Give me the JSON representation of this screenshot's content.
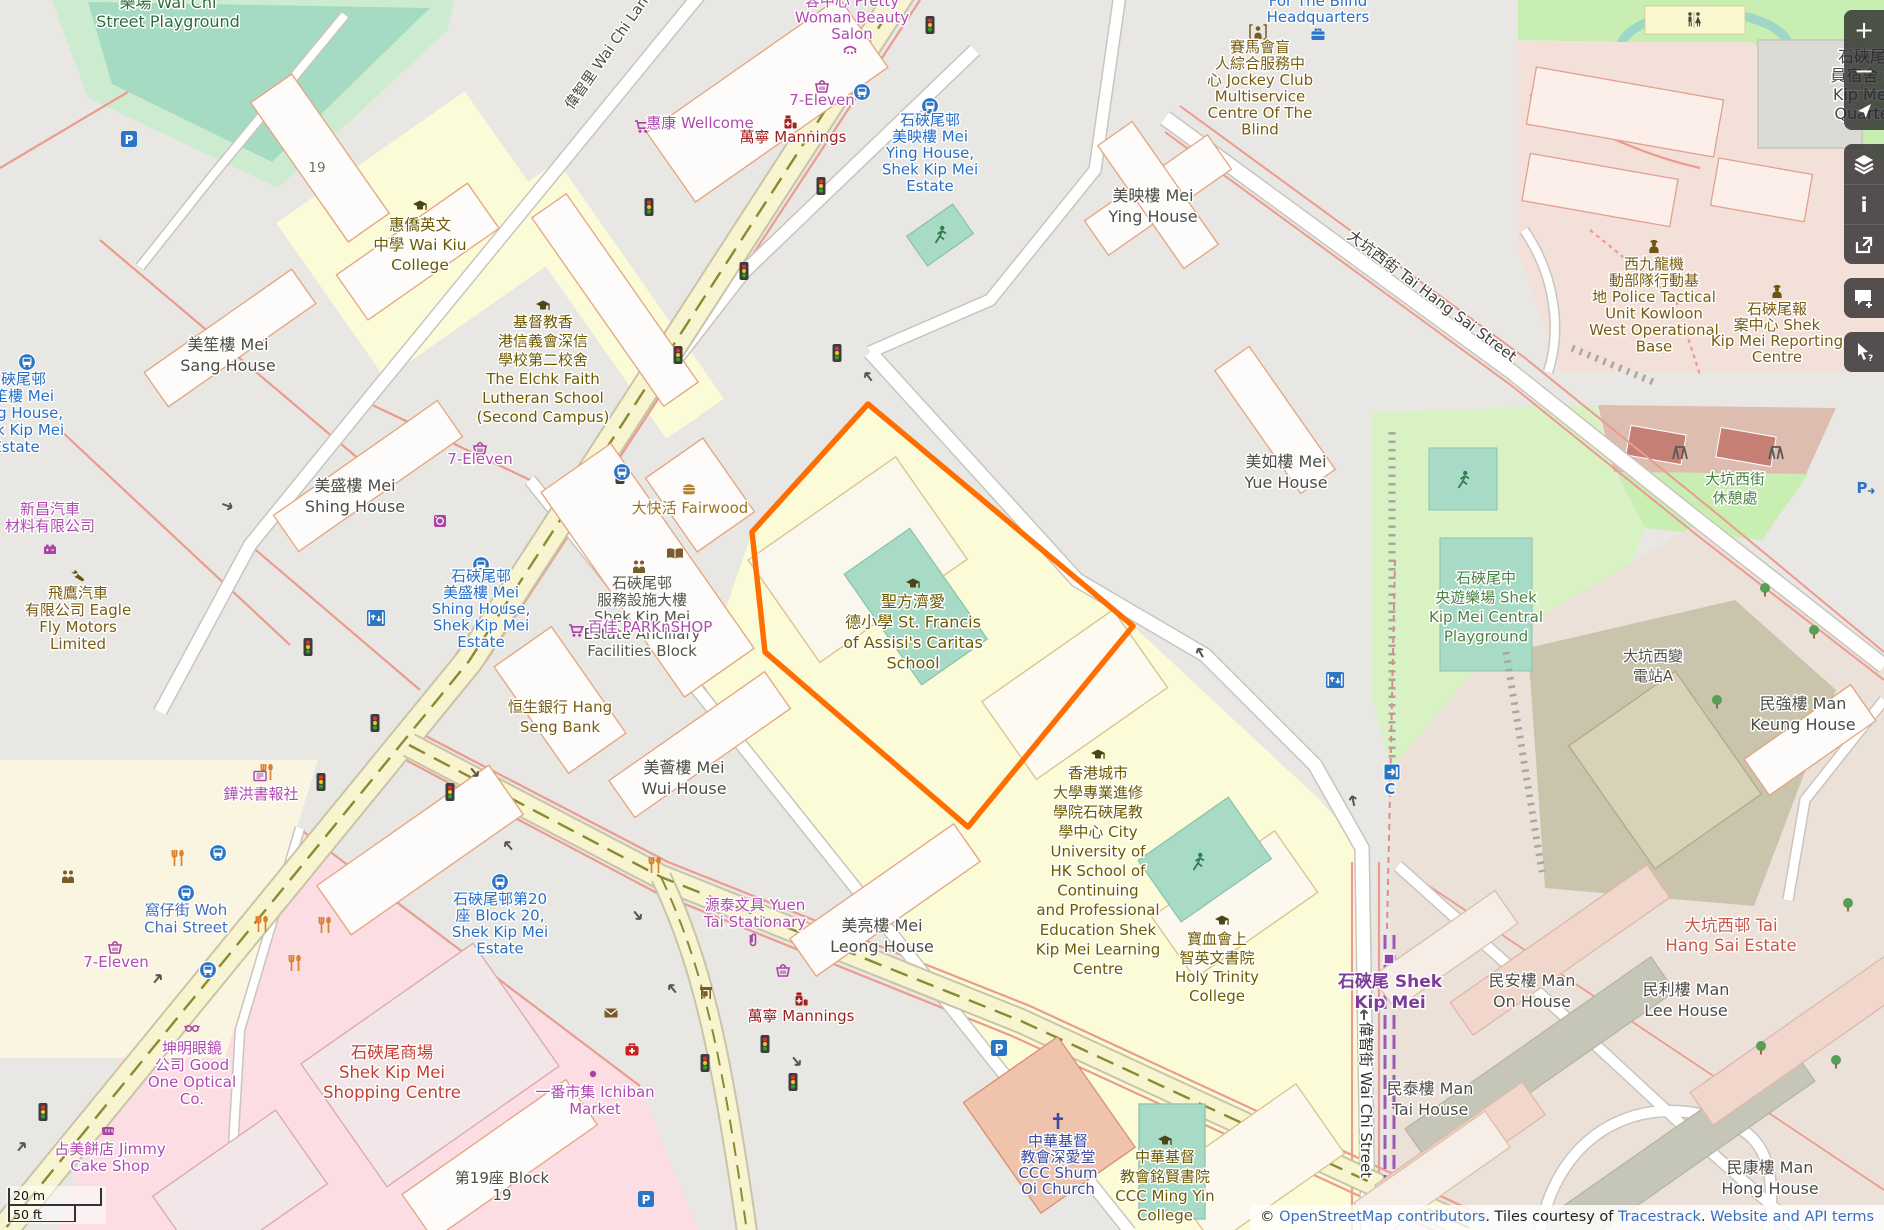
{
  "map": {
    "palette": {
      "selection_orange": "#ff6e00",
      "link_blue": "#3a6fc4",
      "station_purple": "#7d3c98",
      "road_yellow": "#f8f4cf",
      "park_green": "#c8eeb2",
      "pitch_teal": "#a8dbc6"
    },
    "scale_bar": {
      "metric": "20 m",
      "imperial": "50 ft"
    },
    "attribution": {
      "prefix": "© ",
      "osm_link": "OpenStreetMap contributors",
      "sep1": ". Tiles courtesy of ",
      "tiles_link": "Tracestrack",
      "sep2": ". ",
      "terms_link": "Website and API terms"
    },
    "sidebar": {
      "zoom_in": "+",
      "zoom_out": "−",
      "info": "i",
      "buttons": [
        "zoom-in",
        "zoom-out",
        "locate",
        "layers",
        "info",
        "share",
        "add-note",
        "query-features"
      ]
    },
    "selected_feature": {
      "outline_color": "#ff6e00"
    },
    "labels": [
      {
        "t": [
          "樂場 Wai Chi",
          "Street Playground"
        ],
        "x": 168,
        "y": 8,
        "c": "#2f6e3a",
        "s": 16,
        "lh": 19
      },
      {
        "t": [
          "19"
        ],
        "x": 317,
        "y": 172,
        "c": "#6e6e64",
        "s": 13.5
      },
      {
        "t": [
          "惠僑英文",
          "中學 Wai Kiu",
          "College"
        ],
        "x": 420,
        "y": 230,
        "c": "#6d5a00",
        "s": 15.5,
        "lh": 20
      },
      {
        "t": [
          "基督教香",
          "港信義會深信",
          "學校第二校舍",
          "The Elchk Faith",
          "Lutheran School",
          "(Second Campus)"
        ],
        "x": 543,
        "y": 327,
        "c": "#6d5a00",
        "lh": 19
      },
      {
        "t": [
          "美笙樓 Mei",
          "Sang House"
        ],
        "x": 228,
        "y": 350,
        "c": "#4d4c46",
        "s": 16,
        "lh": 21
      },
      {
        "t": [
          "石硤尾邨",
          "美笙樓 Mei",
          "Sang House,",
          "Shek Kip Mei",
          "Estate"
        ],
        "x": 16,
        "y": 384,
        "c": "#2a6fc7",
        "lh": 17
      },
      {
        "t": [
          "新昌汽車",
          "材料有限公司"
        ],
        "x": 50,
        "y": 514,
        "c": "#b14ab0",
        "lh": 17
      },
      {
        "t": [
          "飛鷹汽車",
          "有限公司 Eagle",
          "Fly Motors",
          "Limited"
        ],
        "x": 78,
        "y": 598,
        "c": "#7a5c12",
        "lh": 17
      },
      {
        "t": [
          "美盛樓 Mei",
          "Shing House"
        ],
        "x": 355,
        "y": 491,
        "c": "#4d4c46",
        "s": 16,
        "lh": 21
      },
      {
        "t": [
          "7-Eleven"
        ],
        "x": 480,
        "y": 464,
        "c": "#b14ab0"
      },
      {
        "t": [
          "大快活 Fairwood"
        ],
        "x": 690,
        "y": 513,
        "c": "#9b7618"
      },
      {
        "t": [
          "石硤尾邨",
          "服務設施大樓",
          "Shek Kip Mei",
          "Estate Ancillary",
          "Facilities Block"
        ],
        "x": 642,
        "y": 588,
        "c": "#55544c",
        "lh": 17
      },
      {
        "t": [
          "百佳 PARKnSHOP"
        ],
        "x": 650,
        "y": 632,
        "c": "#b14ab0"
      },
      {
        "t": [
          "恒生銀行 Hang",
          "Seng Bank"
        ],
        "x": 560,
        "y": 712,
        "c": "#7a5c12",
        "lh": 20
      },
      {
        "t": [
          "聖方濟愛",
          "德小學 St. Francis",
          "of Assisi's Caritas",
          "School"
        ],
        "x": 913,
        "y": 607,
        "c": "#6d5a00",
        "s": 16,
        "lh": 20.5
      },
      {
        "t": [
          "美薈樓 Mei",
          "Wui House"
        ],
        "x": 684,
        "y": 773,
        "c": "#4d4c46",
        "s": 16,
        "lh": 21
      },
      {
        "t": [
          "美亮樓 Mei",
          "Leong House"
        ],
        "x": 882,
        "y": 931,
        "c": "#4d4c46",
        "s": 16,
        "lh": 21
      },
      {
        "t": [
          "源泰文具 Yuen",
          "Tai Stationary"
        ],
        "x": 755,
        "y": 910,
        "c": "#b14ab0",
        "lh": 17
      },
      {
        "t": [
          "石硤尾邨第20",
          "座 Block 20,",
          "Shek Kip Mei",
          "Estate"
        ],
        "x": 500,
        "y": 904,
        "c": "#2a6fc7",
        "lh": 16.5
      },
      {
        "t": [
          "萬寧 Mannings"
        ],
        "x": 801,
        "y": 1021,
        "c": "#a01f1f"
      },
      {
        "t": [
          "一番市集 Ichiban",
          "Market"
        ],
        "x": 595,
        "y": 1097,
        "c": "#b14ab0",
        "lh": 17
      },
      {
        "t": [
          "石硤尾商場",
          "Shek Kip Mei",
          "Shopping Centre"
        ],
        "x": 392,
        "y": 1058,
        "c": "#c23f33",
        "s": 16.5,
        "lh": 20
      },
      {
        "t": [
          "坤明眼鏡",
          "公司 Good",
          "One Optical",
          "Co."
        ],
        "x": 192,
        "y": 1053,
        "c": "#b14ab0",
        "lh": 17
      },
      {
        "t": [
          "占美餅店 Jimmy",
          "Cake Shop"
        ],
        "x": 110,
        "y": 1154,
        "c": "#b14ab0",
        "lh": 17
      },
      {
        "t": [
          "窩仔街 Woh",
          "Chai Street"
        ],
        "x": 186,
        "y": 915,
        "c": "#3f6fbe",
        "lh": 17.5
      },
      {
        "t": [
          "7-Eleven"
        ],
        "x": 116,
        "y": 967,
        "c": "#b14ab0"
      },
      {
        "t": [
          "鏵洪書報社"
        ],
        "x": 261,
        "y": 799,
        "c": "#b14ab0"
      },
      {
        "t": [
          "第19座 Block",
          "19"
        ],
        "x": 502,
        "y": 1183,
        "c": "#4d4c46",
        "lh": 17
      },
      {
        "t": [
          "美如樓 Mei",
          "Yue House"
        ],
        "x": 1286,
        "y": 467,
        "c": "#4d4c46",
        "s": 16,
        "lh": 21
      },
      {
        "t": [
          "美映樓 Mei",
          "Ying House"
        ],
        "x": 1153,
        "y": 201,
        "c": "#4d4c46",
        "s": 16,
        "lh": 21
      },
      {
        "t": [
          "石硤尾邨",
          "美映樓 Mei",
          "Ying House,",
          "Shek Kip Mei",
          "Estate"
        ],
        "x": 930,
        "y": 125,
        "c": "#2a6fc7",
        "lh": 16.5
      },
      {
        "t": [
          "容中心 Pretty",
          "Woman Beauty",
          "Salon"
        ],
        "x": 852,
        "y": 6,
        "c": "#b14ab0",
        "lh": 16.5
      },
      {
        "t": [
          "7-Eleven"
        ],
        "x": 822,
        "y": 105,
        "c": "#b14ab0"
      },
      {
        "t": [
          "惠康 Wellcome"
        ],
        "x": 700,
        "y": 128,
        "c": "#b14ab0"
      },
      {
        "t": [
          "萬寧 Mannings"
        ],
        "x": 793,
        "y": 142,
        "c": "#a01f1f"
      },
      {
        "t": [
          "偉智里 Wai Chi Lane"
        ],
        "x": 613,
        "y": 52,
        "c": "#4a4a40",
        "s": 14.5,
        "r": -55
      },
      {
        "t": [
          "大坑西街 Tai Hang Sai Street"
        ],
        "x": 1429,
        "y": 300,
        "c": "#403f39,",
        "s": 15,
        "r": 37
      },
      {
        "t": [
          "偉智街 Wai Chi Street"
        ],
        "x": 1361,
        "y": 1100,
        "c": "#33332e",
        "s": 15,
        "r": 90
      },
      {
        "t": [
          "香港城市",
          "大學專業進修",
          "學院石硤尾教",
          "學中心 City",
          "University of",
          "HK School of",
          "Continuing",
          "and Professional",
          "Education Shek",
          "Kip Mei Learning",
          "Centre"
        ],
        "x": 1098,
        "y": 778,
        "c": "#6d5a00",
        "lh": 19.6
      },
      {
        "t": [
          "寶血會上",
          "智英文書院",
          "Holy Trinity",
          "College"
        ],
        "x": 1217,
        "y": 944,
        "c": "#6d5a00",
        "lh": 19
      },
      {
        "t": [
          "中華基督",
          "教會深愛堂",
          "CCC Shum",
          "Oi Church"
        ],
        "x": 1058,
        "y": 1146,
        "c": "#3c4ba0",
        "lh": 16
      },
      {
        "t": [
          "中華基督",
          "教會銘賢書院",
          "CCC Ming Yin",
          "College"
        ],
        "x": 1165,
        "y": 1162,
        "c": "#6d5a00",
        "lh": 19.5
      },
      {
        "t": [
          "賽馬會盲",
          "人綜合服務中",
          "心 Jockey Club",
          "Multiservice",
          "Centre Of The",
          "Blind"
        ],
        "x": 1260,
        "y": 52,
        "c": "#7a5c12",
        "lh": 16.5
      },
      {
        "t": [
          "For The Blind",
          "Headquarters"
        ],
        "x": 1318,
        "y": 6,
        "c": "#2a6fc7",
        "lh": 16
      },
      {
        "t": [
          "石硤尾中",
          "央遊樂場 Shek",
          "Kip Mei Central",
          "Playground"
        ],
        "x": 1486,
        "y": 583,
        "c": "#4b8142",
        "lh": 19.5
      },
      {
        "t": [
          "大坑西街",
          "休憩處"
        ],
        "x": 1735,
        "y": 484,
        "c": "#4b8142",
        "lh": 19
      },
      {
        "t": [
          "大坑西變",
          "電站A"
        ],
        "x": 1653,
        "y": 661,
        "c": "#50534a",
        "lh": 20
      },
      {
        "t": [
          "民強樓 Man",
          "Keung House"
        ],
        "x": 1803,
        "y": 709,
        "c": "#4d4c46",
        "s": 16,
        "lh": 21
      },
      {
        "t": [
          "民安樓 Man",
          "On House"
        ],
        "x": 1532,
        "y": 986,
        "c": "#4d4c46",
        "s": 16,
        "lh": 21
      },
      {
        "t": [
          "民利樓 Man",
          "Lee House"
        ],
        "x": 1686,
        "y": 995,
        "c": "#4d4c46",
        "s": 16,
        "lh": 21
      },
      {
        "t": [
          "民泰樓 Man",
          "Tai House"
        ],
        "x": 1430,
        "y": 1094,
        "c": "#4d4c46",
        "s": 16,
        "lh": 21
      },
      {
        "t": [
          "民康樓 Man",
          "Hong House"
        ],
        "x": 1770,
        "y": 1173,
        "c": "#4d4c46",
        "s": 16,
        "lh": 21
      },
      {
        "t": [
          "大坑西邨 Tai",
          "Hang Sai Estate"
        ],
        "x": 1731,
        "y": 931,
        "c": "#c65948",
        "s": 16.5,
        "lh": 20
      },
      {
        "t": [
          "石硤尾 Shek",
          "Kip Mei"
        ],
        "x": 1390,
        "y": 987,
        "c": "#7d3c98",
        "s": 17,
        "lh": 21,
        "b": 1
      },
      {
        "t": [
          "C"
        ],
        "x": 1390,
        "y": 794,
        "c": "#2a6fc7",
        "s": 15,
        "b": 1
      },
      {
        "t": [
          "西九龍機",
          "動部隊行動基",
          "地 Police Tactical",
          "Unit Kowloon",
          "West Operational",
          "Base"
        ],
        "x": 1654,
        "y": 269,
        "c": "#7a5c12",
        "lh": 16.5
      },
      {
        "t": [
          "石硤尾報",
          "案中心 Shek",
          "Kip Mei Reporting",
          "Centre"
        ],
        "x": 1777,
        "y": 314,
        "c": "#7a5c12",
        "lh": 16
      },
      {
        "t": [
          "石硤尾",
          "員宿舍 S",
          "Kip Mei",
          "Quarte"
        ],
        "x": 1862,
        "y": 62,
        "c": "#4d4c46",
        "s": 16,
        "lh": 19
      },
      {
        "t": [
          "石硤尾邨",
          "美盛樓 Mei",
          "Shing House,",
          "Shek Kip Mei",
          "Estate"
        ],
        "x": 481,
        "y": 581,
        "c": "#2a6fc7",
        "lh": 16.5
      }
    ],
    "icons": [
      {
        "t": "traffic-light",
        "x": 649,
        "y": 207
      },
      {
        "t": "traffic-light",
        "x": 821,
        "y": 186
      },
      {
        "t": "traffic-light",
        "x": 744,
        "y": 271
      },
      {
        "t": "traffic-light",
        "x": 930,
        "y": 25
      },
      {
        "t": "traffic-light",
        "x": 678,
        "y": 355
      },
      {
        "t": "traffic-light",
        "x": 837,
        "y": 353
      },
      {
        "t": "traffic-light",
        "x": 308,
        "y": 647
      },
      {
        "t": "traffic-light",
        "x": 375,
        "y": 723
      },
      {
        "t": "traffic-light",
        "x": 321,
        "y": 782
      },
      {
        "t": "traffic-light",
        "x": 620,
        "y": 475
      },
      {
        "t": "traffic-light",
        "x": 43,
        "y": 1112
      },
      {
        "t": "traffic-light",
        "x": 450,
        "y": 792
      },
      {
        "t": "traffic-light",
        "x": 765,
        "y": 1044
      },
      {
        "t": "traffic-light",
        "x": 705,
        "y": 1063
      },
      {
        "t": "traffic-light",
        "x": 793,
        "y": 1082
      },
      {
        "t": "bus-stop",
        "x": 862,
        "y": 92
      },
      {
        "t": "bus-stop",
        "x": 930,
        "y": 106
      },
      {
        "t": "bus-stop",
        "x": 27,
        "y": 362
      },
      {
        "t": "bus-stop",
        "x": 481,
        "y": 565
      },
      {
        "t": "bus-stop",
        "x": 622,
        "y": 472
      },
      {
        "t": "bus-stop",
        "x": 500,
        "y": 882
      },
      {
        "t": "bus-stop",
        "x": 218,
        "y": 853
      },
      {
        "t": "bus-stop",
        "x": 186,
        "y": 893
      },
      {
        "t": "bus-stop",
        "x": 208,
        "y": 970
      },
      {
        "t": "elevator",
        "x": 376,
        "y": 618
      },
      {
        "t": "elevator",
        "x": 1335,
        "y": 680
      },
      {
        "t": "entrance",
        "x": 1392,
        "y": 772
      },
      {
        "t": "parking",
        "x": 999,
        "y": 1048
      },
      {
        "t": "parking",
        "x": 646,
        "y": 1199
      },
      {
        "t": "parking",
        "x": 129,
        "y": 139
      },
      {
        "t": "parking-arrow",
        "x": 1862,
        "y": 488
      },
      {
        "t": "restaurant",
        "x": 178,
        "y": 858
      },
      {
        "t": "restaurant",
        "x": 262,
        "y": 924
      },
      {
        "t": "restaurant",
        "x": 325,
        "y": 925
      },
      {
        "t": "restaurant",
        "x": 295,
        "y": 963
      },
      {
        "t": "restaurant",
        "x": 655,
        "y": 865
      },
      {
        "t": "restaurant",
        "x": 267,
        "y": 772
      },
      {
        "t": "tree",
        "x": 1765,
        "y": 590
      },
      {
        "t": "tree",
        "x": 1814,
        "y": 632
      },
      {
        "t": "tree",
        "x": 1717,
        "y": 702
      },
      {
        "t": "tree",
        "x": 1761,
        "y": 1048
      },
      {
        "t": "tree",
        "x": 1836,
        "y": 1062
      },
      {
        "t": "tree",
        "x": 1848,
        "y": 905
      },
      {
        "t": "runner",
        "x": 1463,
        "y": 480
      },
      {
        "t": "runner",
        "x": 1198,
        "y": 862
      },
      {
        "t": "runner",
        "x": 940,
        "y": 235
      },
      {
        "t": "school",
        "x": 420,
        "y": 206
      },
      {
        "t": "school",
        "x": 543,
        "y": 306
      },
      {
        "t": "school",
        "x": 913,
        "y": 584
      },
      {
        "t": "school",
        "x": 1098,
        "y": 755
      },
      {
        "t": "school",
        "x": 1222,
        "y": 921
      },
      {
        "t": "school",
        "x": 1165,
        "y": 1141
      },
      {
        "t": "book",
        "x": 675,
        "y": 554
      },
      {
        "t": "community",
        "x": 639,
        "y": 567
      },
      {
        "t": "community",
        "x": 68,
        "y": 877
      },
      {
        "t": "burger",
        "x": 689,
        "y": 489
      },
      {
        "t": "cart",
        "x": 642,
        "y": 127
      },
      {
        "t": "cart",
        "x": 576,
        "y": 631
      },
      {
        "t": "basket",
        "x": 822,
        "y": 86
      },
      {
        "t": "basket",
        "x": 480,
        "y": 448
      },
      {
        "t": "basket",
        "x": 115,
        "y": 947
      },
      {
        "t": "basket",
        "x": 783,
        "y": 970
      },
      {
        "t": "pharmacy",
        "x": 790,
        "y": 122
      },
      {
        "t": "pharmacy",
        "x": 801,
        "y": 999
      },
      {
        "t": "mail",
        "x": 611,
        "y": 1013
      },
      {
        "t": "clinic",
        "x": 632,
        "y": 1050
      },
      {
        "t": "briefcase",
        "x": 1318,
        "y": 35
      },
      {
        "t": "social",
        "x": 1258,
        "y": 32
      },
      {
        "t": "police",
        "x": 1654,
        "y": 246
      },
      {
        "t": "police",
        "x": 1777,
        "y": 291
      },
      {
        "t": "toilets",
        "x": 1694,
        "y": 20
      },
      {
        "t": "glasses",
        "x": 192,
        "y": 1028
      },
      {
        "t": "bread",
        "x": 108,
        "y": 1130
      },
      {
        "t": "paperclip",
        "x": 753,
        "y": 941
      },
      {
        "t": "newsagent",
        "x": 260,
        "y": 776
      },
      {
        "t": "beauty",
        "x": 850,
        "y": 49
      },
      {
        "t": "dot",
        "x": 593,
        "y": 1074
      },
      {
        "t": "church",
        "x": 1058,
        "y": 1121
      },
      {
        "t": "battery",
        "x": 50,
        "y": 550
      },
      {
        "t": "car-repair",
        "x": 77,
        "y": 575
      },
      {
        "t": "laundry",
        "x": 440,
        "y": 521
      },
      {
        "t": "swing",
        "x": 1680,
        "y": 453
      },
      {
        "t": "swing",
        "x": 1776,
        "y": 453
      },
      {
        "t": "shelter",
        "x": 706,
        "y": 993
      },
      {
        "t": "station-square",
        "x": 1389,
        "y": 959
      },
      {
        "t": "oneway",
        "x": 868,
        "y": 376,
        "r": -38
      },
      {
        "t": "oneway",
        "x": 1200,
        "y": 652,
        "r": -30
      },
      {
        "t": "oneway",
        "x": 1353,
        "y": 800,
        "r": -12
      },
      {
        "t": "oneway",
        "x": 1364,
        "y": 1014,
        "r": 0
      },
      {
        "t": "oneway",
        "x": 475,
        "y": 773,
        "r": 140
      },
      {
        "t": "oneway",
        "x": 508,
        "y": 845,
        "r": -40
      },
      {
        "t": "oneway",
        "x": 638,
        "y": 916,
        "r": 140
      },
      {
        "t": "oneway",
        "x": 672,
        "y": 988,
        "r": -40
      },
      {
        "t": "oneway",
        "x": 797,
        "y": 1062,
        "r": 140
      },
      {
        "t": "oneway",
        "x": 158,
        "y": 978,
        "r": 40
      },
      {
        "t": "oneway",
        "x": 22,
        "y": 1146,
        "r": 40
      },
      {
        "t": "oneway",
        "x": 228,
        "y": 506,
        "r": 110
      }
    ]
  }
}
